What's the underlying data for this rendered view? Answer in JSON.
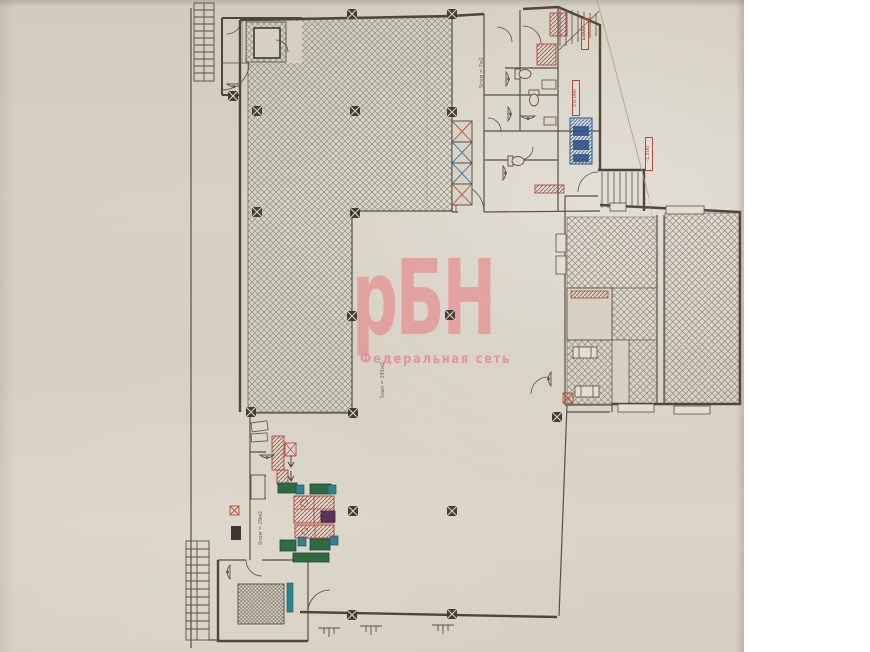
{
  "watermark": {
    "title": "рБН",
    "subtitle": "Федеральная сеть"
  },
  "labels": {
    "elevations": [
      {
        "text": "1.000"
      },
      {
        "text": "±0.000"
      },
      {
        "text": "-1.500"
      }
    ],
    "areas": [
      {
        "text": "Sпом = 7м2"
      },
      {
        "text": "Sзал = 291м2"
      },
      {
        "text": "Sпом = 29м2"
      }
    ]
  },
  "colors": {
    "watermark_pink": "#e8797f",
    "paper": "#d6d0c2",
    "ink": "#565046",
    "hatch_green": "#8a927c",
    "hatch_brown": "#948b7d",
    "fixture_red": "#a84438",
    "fixture_green": "#2e6b45",
    "fixture_blue": "#33619c",
    "fixture_teal": "#2e8391",
    "fixture_purple": "#57355f"
  }
}
